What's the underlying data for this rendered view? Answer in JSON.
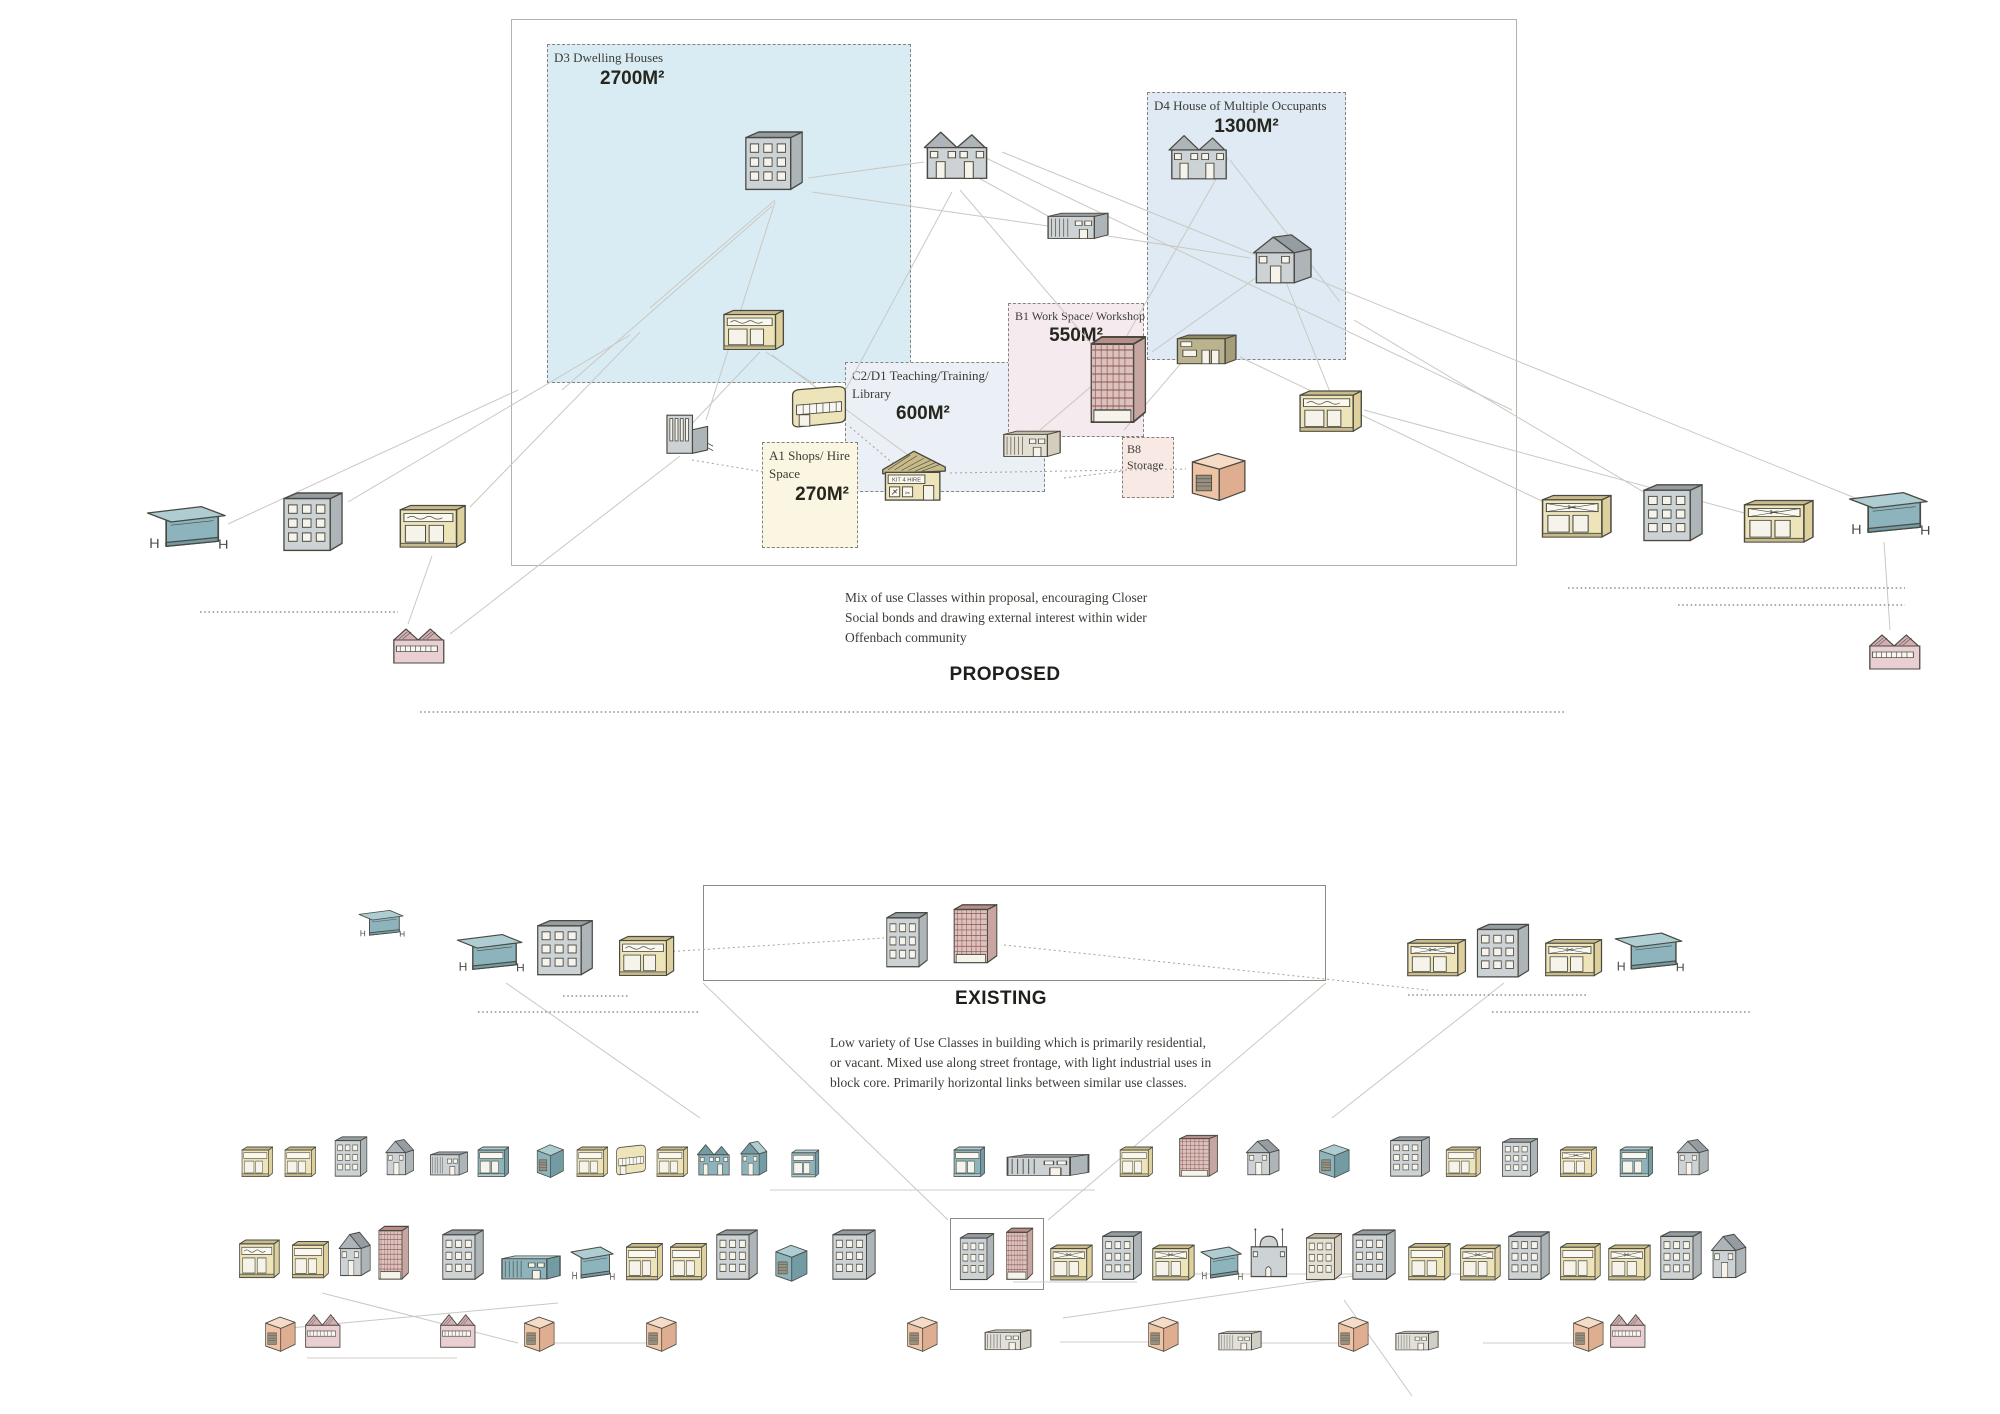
{
  "titles": {
    "proposed": "PROPOSED",
    "existing": "EXISTING"
  },
  "notes": {
    "proposed": "Mix of use Classes within proposal, encouraging Closer Social bonds and drawing external interest within wider Offenbach community",
    "existing": "Low variety of Use Classes in building which is primarily residential, or vacant. Mixed use along street frontage, with light industrial uses in block core. Primarily horizontal links between similar use classes."
  },
  "zones": [
    {
      "code": "D3",
      "label": "D3 Dwelling Houses",
      "area": "2700M²"
    },
    {
      "code": "D4",
      "label": "D4 House of Multiple Occupants",
      "area": "1300M²"
    },
    {
      "code": "B1",
      "label": "B1 Work Space/ Workshop",
      "area": "550M²"
    },
    {
      "code": "C2/D1",
      "label": "C2/D1 Teaching/Training/ Library",
      "area": "600M²"
    },
    {
      "code": "A1",
      "label": "A1 Shops/ Hire Space",
      "area": "270M²"
    },
    {
      "code": "B8",
      "label": "B8 Storage",
      "area": ""
    }
  ],
  "signs": {
    "kit_hire": "KIT 4 HIRE"
  },
  "colors": {
    "yellow": {
      "f": "#eee4ba",
      "s": "#ddd09c",
      "r": "#c9bb89"
    },
    "grey": {
      "f": "#cdd2d5",
      "s": "#aeb5b9",
      "r": "#969da2"
    },
    "teal": {
      "f": "#8db4bc",
      "s": "#739ba4",
      "r": "#aecdd2"
    },
    "maroon": {
      "f": "#dcc2be",
      "s": "#c7a6a2",
      "r": "#b98e89",
      "g": "#8a544f"
    },
    "salmon": {
      "f": "#eec3a6",
      "s": "#dfae90",
      "r": "#e7b89a",
      "t": "#f6dcc6"
    },
    "pink": {
      "f": "#e9ced2",
      "s": "#d8b7bc",
      "r": "#d3aeb3"
    },
    "olive": {
      "f": "#bab38d",
      "s": "#a49d77",
      "r": "#8f8964"
    },
    "beige": {
      "f": "#e5dfd1",
      "s": "#d4cdbd",
      "r": "#c2baa7"
    },
    "lightgrey": {
      "f": "#e3e0d9",
      "s": "#d1cec5",
      "r": "#bfbcb2"
    }
  },
  "buildings": {
    "proposed": [
      {
        "t": "apartment",
        "c": "grey",
        "x": 742,
        "y": 125,
        "w": 64,
        "h": 70
      },
      {
        "t": "semi",
        "c": "grey",
        "x": 920,
        "y": 122,
        "w": 74,
        "h": 64
      },
      {
        "t": "industrial",
        "c": "grey",
        "x": 1044,
        "y": 198,
        "w": 68,
        "h": 46
      },
      {
        "t": "semi",
        "c": "grey",
        "x": 1165,
        "y": 126,
        "w": 68,
        "h": 60
      },
      {
        "t": "house",
        "c": "grey",
        "x": 1248,
        "y": 230,
        "w": 70,
        "h": 60
      },
      {
        "t": "bakery",
        "c": "yellow",
        "x": 720,
        "y": 296,
        "w": 66,
        "h": 58
      },
      {
        "t": "towergrid",
        "c": "maroon",
        "x": 1086,
        "y": 330,
        "w": 66,
        "h": 100
      },
      {
        "t": "workshop",
        "c": "olive",
        "x": 1172,
        "y": 320,
        "w": 68,
        "h": 52
      },
      {
        "t": "bakery",
        "c": "yellow",
        "x": 1296,
        "y": 376,
        "w": 68,
        "h": 60
      },
      {
        "t": "church",
        "c": "grey",
        "x": 660,
        "y": 404,
        "w": 58,
        "h": 56
      },
      {
        "t": "curved",
        "c": "yellow",
        "x": 786,
        "y": 374,
        "w": 66,
        "h": 60
      },
      {
        "t": "kithire",
        "c": "yellow",
        "x": 880,
        "y": 442,
        "w": 68,
        "h": 66
      },
      {
        "t": "industrial",
        "c": "beige",
        "x": 1000,
        "y": 416,
        "w": 64,
        "h": 46
      },
      {
        "t": "shed",
        "c": "salmon",
        "x": 1186,
        "y": 444,
        "w": 64,
        "h": 60
      },
      {
        "t": "cafe",
        "c": "teal",
        "x": 146,
        "y": 490,
        "w": 84,
        "h": 64
      },
      {
        "t": "apartment",
        "c": "grey",
        "x": 280,
        "y": 486,
        "w": 66,
        "h": 70
      },
      {
        "t": "bakery",
        "c": "yellow",
        "x": 396,
        "y": 490,
        "w": 72,
        "h": 62
      },
      {
        "t": "factory",
        "c": "pink",
        "x": 390,
        "y": 620,
        "w": 64,
        "h": 50
      },
      {
        "t": "barbershop",
        "c": "yellow",
        "x": 1538,
        "y": 480,
        "w": 76,
        "h": 62
      },
      {
        "t": "apartment",
        "c": "grey",
        "x": 1640,
        "y": 478,
        "w": 66,
        "h": 68
      },
      {
        "t": "barbershop",
        "c": "yellow",
        "x": 1740,
        "y": 485,
        "w": 76,
        "h": 62
      },
      {
        "t": "cafe",
        "c": "teal",
        "x": 1848,
        "y": 476,
        "w": 84,
        "h": 64
      },
      {
        "t": "factory",
        "c": "pink",
        "x": 1866,
        "y": 626,
        "w": 64,
        "h": 50
      }
    ],
    "existing": [
      {
        "t": "cafe",
        "c": "teal",
        "x": 358,
        "y": 900,
        "w": 48,
        "h": 40
      },
      {
        "t": "cafe",
        "c": "teal",
        "x": 456,
        "y": 920,
        "w": 70,
        "h": 56
      },
      {
        "t": "apartment",
        "c": "grey",
        "x": 534,
        "y": 914,
        "w": 62,
        "h": 66
      },
      {
        "t": "bakery",
        "c": "yellow",
        "x": 616,
        "y": 922,
        "w": 60,
        "h": 58
      },
      {
        "t": "apartment",
        "c": "grey",
        "x": 884,
        "y": 906,
        "w": 46,
        "h": 66
      },
      {
        "t": "towergrid",
        "c": "maroon",
        "x": 950,
        "y": 900,
        "w": 52,
        "h": 68
      },
      {
        "t": "barbershop",
        "c": "yellow",
        "x": 1404,
        "y": 926,
        "w": 64,
        "h": 54
      },
      {
        "t": "apartment",
        "c": "grey",
        "x": 1474,
        "y": 918,
        "w": 58,
        "h": 64
      },
      {
        "t": "barbershop",
        "c": "yellow",
        "x": 1542,
        "y": 926,
        "w": 62,
        "h": 54
      },
      {
        "t": "cafe",
        "c": "teal",
        "x": 1614,
        "y": 918,
        "w": 72,
        "h": 58
      },
      {
        "t": "shop",
        "c": "yellow",
        "x": 240,
        "y": 1136,
        "w": 34,
        "h": 44
      },
      {
        "t": "shop",
        "c": "yellow",
        "x": 283,
        "y": 1136,
        "w": 34,
        "h": 44
      },
      {
        "t": "apartment",
        "c": "grey",
        "x": 333,
        "y": 1132,
        "w": 36,
        "h": 48
      },
      {
        "t": "house",
        "c": "grey",
        "x": 383,
        "y": 1136,
        "w": 34,
        "h": 44
      },
      {
        "t": "industrial",
        "c": "grey",
        "x": 428,
        "y": 1138,
        "w": 42,
        "h": 42
      },
      {
        "t": "shop",
        "c": "teal",
        "x": 476,
        "y": 1136,
        "w": 34,
        "h": 44
      },
      {
        "t": "shed",
        "c": "teal",
        "x": 534,
        "y": 1138,
        "w": 32,
        "h": 42
      },
      {
        "t": "shop",
        "c": "yellow",
        "x": 575,
        "y": 1136,
        "w": 34,
        "h": 44
      },
      {
        "t": "curved",
        "c": "yellow",
        "x": 613,
        "y": 1136,
        "w": 36,
        "h": 44
      },
      {
        "t": "shop",
        "c": "yellow",
        "x": 655,
        "y": 1136,
        "w": 34,
        "h": 44
      },
      {
        "t": "semi",
        "c": "teal",
        "x": 695,
        "y": 1138,
        "w": 38,
        "h": 42
      },
      {
        "t": "house",
        "c": "teal",
        "x": 738,
        "y": 1138,
        "w": 32,
        "h": 42
      },
      {
        "t": "shop",
        "c": "teal",
        "x": 790,
        "y": 1140,
        "w": 30,
        "h": 40
      },
      {
        "t": "shop",
        "c": "teal",
        "x": 952,
        "y": 1136,
        "w": 34,
        "h": 44
      },
      {
        "t": "industrial",
        "c": "grey",
        "x": 1002,
        "y": 1142,
        "w": 92,
        "h": 38
      },
      {
        "t": "shop",
        "c": "yellow",
        "x": 1118,
        "y": 1136,
        "w": 36,
        "h": 44
      },
      {
        "t": "towergrid",
        "c": "maroon",
        "x": 1176,
        "y": 1132,
        "w": 46,
        "h": 48
      },
      {
        "t": "house",
        "c": "grey",
        "x": 1243,
        "y": 1136,
        "w": 40,
        "h": 44
      },
      {
        "t": "shed",
        "c": "teal",
        "x": 1316,
        "y": 1138,
        "w": 36,
        "h": 42
      },
      {
        "t": "apartment",
        "c": "grey",
        "x": 1388,
        "y": 1132,
        "w": 44,
        "h": 48
      },
      {
        "t": "shop",
        "c": "yellow",
        "x": 1444,
        "y": 1136,
        "w": 38,
        "h": 44
      },
      {
        "t": "apartment",
        "c": "grey",
        "x": 1500,
        "y": 1134,
        "w": 40,
        "h": 46
      },
      {
        "t": "barbershop",
        "c": "yellow",
        "x": 1558,
        "y": 1136,
        "w": 40,
        "h": 44
      },
      {
        "t": "shop",
        "c": "teal",
        "x": 1618,
        "y": 1136,
        "w": 36,
        "h": 44
      },
      {
        "t": "house",
        "c": "grey",
        "x": 1674,
        "y": 1136,
        "w": 38,
        "h": 44
      },
      {
        "t": "bakery",
        "c": "yellow",
        "x": 237,
        "y": 1226,
        "w": 44,
        "h": 56
      },
      {
        "t": "shop",
        "c": "yellow",
        "x": 290,
        "y": 1228,
        "w": 40,
        "h": 54
      },
      {
        "t": "house",
        "c": "grey",
        "x": 336,
        "y": 1228,
        "w": 38,
        "h": 54
      },
      {
        "t": "towergrid",
        "c": "maroon",
        "x": 376,
        "y": 1222,
        "w": 36,
        "h": 62
      },
      {
        "t": "apartment",
        "c": "grey",
        "x": 440,
        "y": 1224,
        "w": 46,
        "h": 60
      },
      {
        "t": "industrial",
        "c": "teal",
        "x": 498,
        "y": 1242,
        "w": 66,
        "h": 42
      },
      {
        "t": "cafe",
        "c": "teal",
        "x": 570,
        "y": 1234,
        "w": 46,
        "h": 50
      },
      {
        "t": "shop",
        "c": "yellow",
        "x": 624,
        "y": 1230,
        "w": 40,
        "h": 54
      },
      {
        "t": "shop",
        "c": "yellow",
        "x": 668,
        "y": 1230,
        "w": 40,
        "h": 54
      },
      {
        "t": "apartment",
        "c": "grey",
        "x": 714,
        "y": 1224,
        "w": 46,
        "h": 60
      },
      {
        "t": "shed",
        "c": "teal",
        "x": 772,
        "y": 1238,
        "w": 38,
        "h": 46
      },
      {
        "t": "apartment",
        "c": "grey",
        "x": 830,
        "y": 1224,
        "w": 48,
        "h": 60
      },
      {
        "t": "apartment",
        "c": "grey",
        "x": 958,
        "y": 1228,
        "w": 38,
        "h": 56
      },
      {
        "t": "towergrid",
        "c": "maroon",
        "x": 1004,
        "y": 1224,
        "w": 32,
        "h": 60
      },
      {
        "t": "barbershop",
        "c": "yellow",
        "x": 1048,
        "y": 1232,
        "w": 46,
        "h": 52
      },
      {
        "t": "apartment",
        "c": "grey",
        "x": 1100,
        "y": 1226,
        "w": 44,
        "h": 58
      },
      {
        "t": "barbershop",
        "c": "yellow",
        "x": 1150,
        "y": 1232,
        "w": 46,
        "h": 52
      },
      {
        "t": "cafe",
        "c": "teal",
        "x": 1200,
        "y": 1234,
        "w": 44,
        "h": 50
      },
      {
        "t": "mosque",
        "c": "grey",
        "x": 1246,
        "y": 1222,
        "w": 52,
        "h": 62
      },
      {
        "t": "apartment",
        "c": "beige",
        "x": 1304,
        "y": 1228,
        "w": 40,
        "h": 56
      },
      {
        "t": "apartment",
        "c": "grey",
        "x": 1350,
        "y": 1224,
        "w": 48,
        "h": 60
      },
      {
        "t": "shop",
        "c": "yellow",
        "x": 1406,
        "y": 1230,
        "w": 46,
        "h": 54
      },
      {
        "t": "barbershop",
        "c": "yellow",
        "x": 1458,
        "y": 1232,
        "w": 44,
        "h": 52
      },
      {
        "t": "apartment",
        "c": "grey",
        "x": 1506,
        "y": 1226,
        "w": 46,
        "h": 58
      },
      {
        "t": "shop",
        "c": "yellow",
        "x": 1558,
        "y": 1230,
        "w": 44,
        "h": 54
      },
      {
        "t": "barbershop",
        "c": "yellow",
        "x": 1606,
        "y": 1232,
        "w": 46,
        "h": 52
      },
      {
        "t": "apartment",
        "c": "grey",
        "x": 1658,
        "y": 1226,
        "w": 46,
        "h": 58
      },
      {
        "t": "house",
        "c": "grey",
        "x": 1708,
        "y": 1230,
        "w": 42,
        "h": 54
      },
      {
        "t": "shed",
        "c": "salmon",
        "x": 262,
        "y": 1310,
        "w": 36,
        "h": 44
      },
      {
        "t": "factory",
        "c": "pink",
        "x": 303,
        "y": 1306,
        "w": 44,
        "h": 48
      },
      {
        "t": "factory",
        "c": "pink",
        "x": 438,
        "y": 1306,
        "w": 44,
        "h": 48
      },
      {
        "t": "shed",
        "c": "salmon",
        "x": 521,
        "y": 1310,
        "w": 36,
        "h": 44
      },
      {
        "t": "shed",
        "c": "salmon",
        "x": 643,
        "y": 1310,
        "w": 36,
        "h": 44
      },
      {
        "t": "shed",
        "c": "salmon",
        "x": 904,
        "y": 1310,
        "w": 36,
        "h": 44
      },
      {
        "t": "industrial",
        "c": "lightgrey",
        "x": 982,
        "y": 1318,
        "w": 52,
        "h": 36
      },
      {
        "t": "shed",
        "c": "salmon",
        "x": 1145,
        "y": 1310,
        "w": 36,
        "h": 44
      },
      {
        "t": "industrial",
        "c": "lightgrey",
        "x": 1216,
        "y": 1320,
        "w": 48,
        "h": 34
      },
      {
        "t": "shed",
        "c": "salmon",
        "x": 1335,
        "y": 1310,
        "w": 36,
        "h": 44
      },
      {
        "t": "industrial",
        "c": "lightgrey",
        "x": 1393,
        "y": 1320,
        "w": 48,
        "h": 34
      },
      {
        "t": "shed",
        "c": "salmon",
        "x": 1570,
        "y": 1310,
        "w": 36,
        "h": 44
      },
      {
        "t": "factory",
        "c": "pink",
        "x": 1608,
        "y": 1306,
        "w": 44,
        "h": 48
      }
    ]
  },
  "lines": {
    "connectors": [
      [
        775,
        200,
        650,
        308
      ],
      [
        775,
        202,
        706,
        420
      ],
      [
        772,
        206,
        562,
        390
      ],
      [
        808,
        178,
        924,
        162
      ],
      [
        812,
        192,
        1048,
        226
      ],
      [
        766,
        352,
        814,
        384
      ],
      [
        760,
        352,
        684,
        432
      ],
      [
        772,
        355,
        912,
        458
      ],
      [
        960,
        190,
        1100,
        354
      ],
      [
        952,
        192,
        840,
        400
      ],
      [
        975,
        176,
        1048,
        216
      ],
      [
        1082,
        232,
        1250,
        258
      ],
      [
        1228,
        158,
        1120,
        348
      ],
      [
        1230,
        160,
        1340,
        302
      ],
      [
        1264,
        272,
        1152,
        352
      ],
      [
        1282,
        272,
        1330,
        392
      ],
      [
        1120,
        362,
        1040,
        430
      ],
      [
        1124,
        430,
        1206,
        334
      ],
      [
        640,
        332,
        470,
        507
      ],
      [
        630,
        335,
        348,
        502
      ],
      [
        680,
        456,
        450,
        634
      ],
      [
        1240,
        357,
        1548,
        504
      ],
      [
        1354,
        320,
        1652,
        497
      ],
      [
        1364,
        410,
        1748,
        514
      ],
      [
        1002,
        152,
        1860,
        500
      ],
      [
        965,
        148,
        1512,
        410
      ],
      [
        432,
        556,
        408,
        624
      ],
      [
        1884,
        542,
        1890,
        630
      ],
      [
        518,
        390,
        228,
        524
      ],
      [
        703,
        983,
        948,
        1220
      ],
      [
        1326,
        983,
        1048,
        1220
      ],
      [
        506,
        983,
        700,
        1118
      ],
      [
        1504,
        983,
        1332,
        1118
      ],
      [
        290,
        1328,
        558,
        1303
      ],
      [
        322,
        1293,
        518,
        1343
      ],
      [
        1344,
        1300,
        1412,
        1396
      ],
      [
        1063,
        1318,
        1360,
        1275
      ]
    ],
    "dotted": [
      [
        692,
        460,
        764,
        472
      ],
      [
        850,
        427,
        894,
        464
      ],
      [
        950,
        473,
        1186,
        469
      ],
      [
        1064,
        478,
        1124,
        471
      ],
      [
        648,
        953,
        884,
        938
      ],
      [
        1004,
        945,
        1428,
        990
      ]
    ],
    "dotted_rules": [
      [
        200,
        612,
        398,
        612
      ],
      [
        1568,
        588,
        1905,
        588
      ],
      [
        1678,
        605,
        1905,
        605
      ],
      [
        420,
        712,
        1565,
        712
      ],
      [
        563,
        996,
        628,
        996
      ],
      [
        478,
        1012,
        700,
        1012
      ],
      [
        1408,
        995,
        1588,
        995
      ],
      [
        1492,
        1012,
        1752,
        1012
      ]
    ],
    "underlines": [
      [
        1013,
        1282,
        1137,
        1282
      ],
      [
        1152,
        1274,
        1358,
        1274
      ],
      [
        1418,
        1274,
        1468,
        1274
      ],
      [
        307,
        1358,
        457,
        1358
      ],
      [
        532,
        1343,
        662,
        1343
      ],
      [
        1235,
        1343,
        1347,
        1343
      ],
      [
        1483,
        1343,
        1577,
        1343
      ],
      [
        1060,
        1342,
        1177,
        1342
      ],
      [
        770,
        1190,
        1095,
        1190
      ]
    ]
  }
}
